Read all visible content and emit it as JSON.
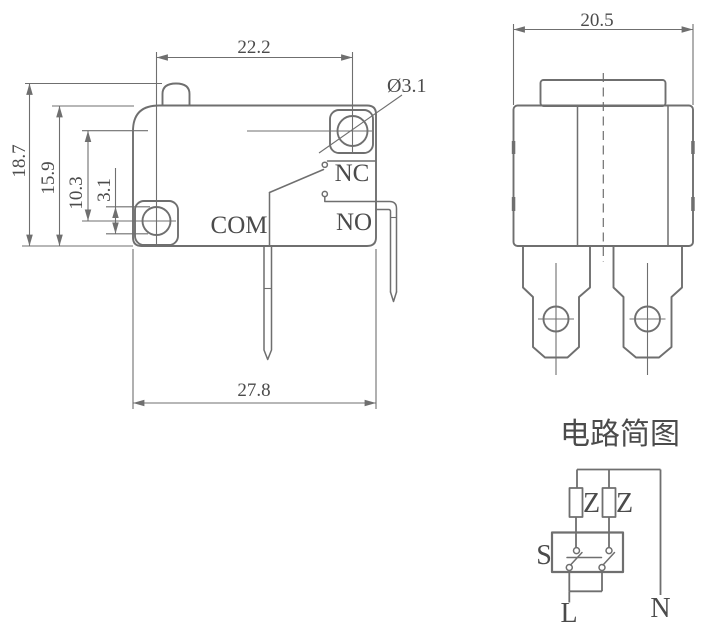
{
  "drawing": {
    "kind": "technical-drawing",
    "component": "micro-switch"
  },
  "front_view": {
    "dim_top_width": "22.2",
    "dim_hole_diameter": "Ø3.1",
    "dim_total_height": "18.7",
    "dim_body_height": "15.9",
    "dim_hole_offset": "10.3",
    "dim_left_hole": "3.1",
    "dim_bottom_width": "27.8",
    "terminal_nc": "NC",
    "terminal_no": "NO",
    "terminal_com": "COM"
  },
  "side_view": {
    "dim_width": "20.5"
  },
  "circuit_diagram": {
    "title": "电路简图",
    "resistor_1": "Z",
    "resistor_2": "Z",
    "switch_label": "S",
    "line_label": "L",
    "neutral_label": "N"
  },
  "colors": {
    "line": "#6f6f6f",
    "text": "#4b4b4b",
    "background": "#ffffff"
  }
}
